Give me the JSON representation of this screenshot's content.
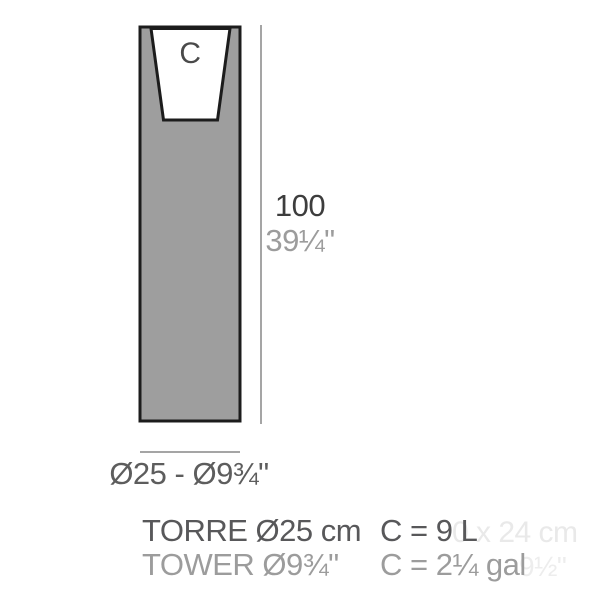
{
  "diagram": {
    "cavity_label": "C",
    "height_label_cm": "100",
    "height_label_in": "39¼\"",
    "width_label": "Ø25 - Ø9¾\"",
    "colors": {
      "planter_fill": "#9e9e9e",
      "planter_outline": "#1c1c1c",
      "cavity_fill": "#ffffff",
      "dimension_line": "#a5a5a5"
    }
  },
  "caption": {
    "product_name_metric": "TORRE Ø25 cm",
    "product_name_imperial": "TOWER Ø9¾\"",
    "capacity_metric": "C = 9 L",
    "capacity_imperial": "C = 2¼ gal"
  },
  "watermark": {
    "line1": "0 x 24 cm",
    "line2": "9½\""
  }
}
